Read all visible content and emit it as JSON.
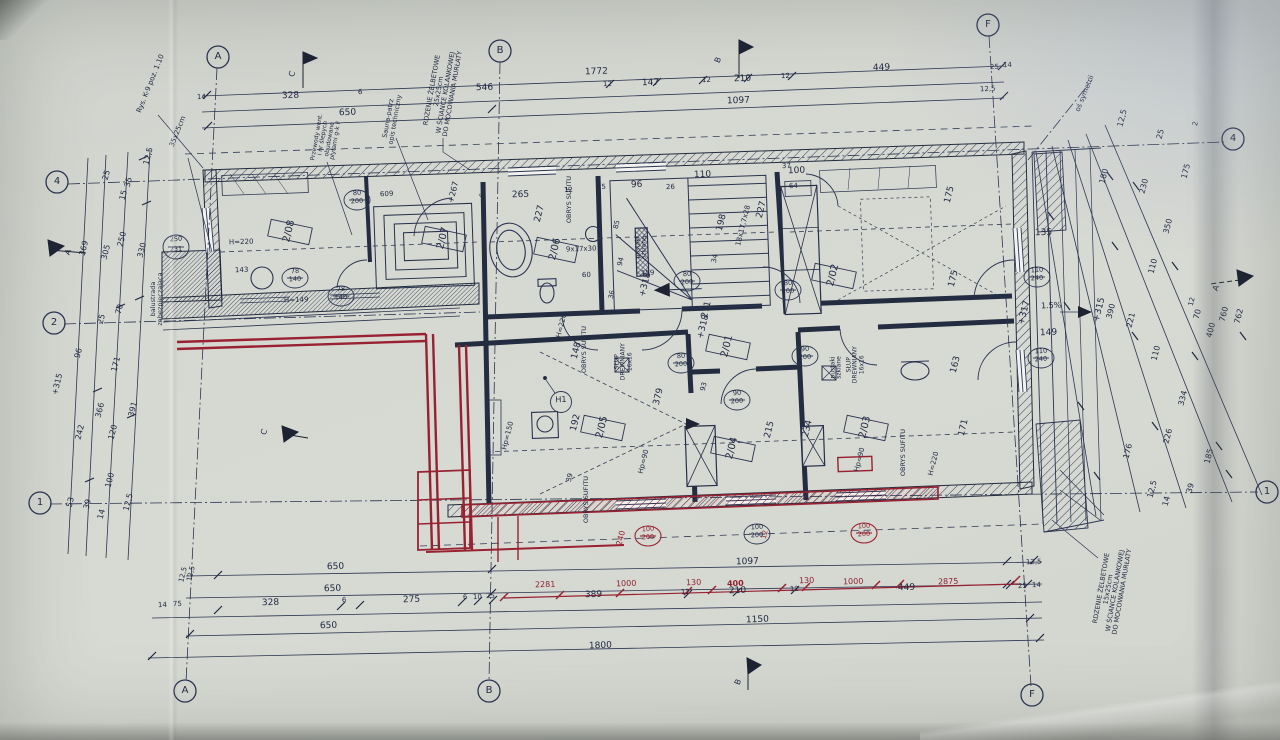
{
  "axes": {
    "A": "A",
    "B": "B",
    "C": "C",
    "F": "F",
    "n1": "1",
    "n2": "2",
    "n4": "4"
  },
  "rooms": {
    "r01": "2/01",
    "r02": "2/02",
    "r03": "2/03",
    "r04": "2/04",
    "r05": "2/05",
    "r06": "2/06",
    "r07": "2/07",
    "r08": "2/08",
    "h1": "H1"
  },
  "doors": {
    "d80": {
      "w": "80",
      "h": "200"
    },
    "d78": {
      "w": "78",
      "h": "140"
    },
    "d90": {
      "w": "90",
      "h": "200"
    },
    "d110": {
      "w": "110",
      "h": "240"
    },
    "d100": {
      "w": "100",
      "h": "200"
    },
    "d250": {
      "w": "250",
      "h": "231"
    },
    "ref609": "609"
  },
  "levels": {
    "p267": "+267",
    "p315": "+315",
    "p317": "+317",
    "p318": "+318",
    "slope": "1.5%"
  },
  "notes": {
    "rys": "Rys. K-9 poz. 1.10",
    "s3525": "35x25cm",
    "rdz25": "RDZENIE ŻELBETOWE\n25x25cm\nW ŚCIANCE KOLANKOWEJ\nDO MOCOWANIA MURŁATY",
    "rdz15": "RDZENIE ŻELBETOWE\n15x25cm\nW ŚCIANCE KOLANKOWEJ\nDO MOCOWANIA MURŁATY",
    "sauna": "Sauna-patrz\nopis techniczny",
    "przewody": "Przewody went.\ni nr ślepych\nobudowane\npłytami g-k F",
    "balustrada": "balustrada\nzabezpieczająca",
    "os": "oś symetrii",
    "obrys": "OBRYS SUFITU",
    "slup": "SŁUP\nDREWNIANY\n16x16",
    "pustaki": "pustaki\nszklane"
  },
  "dims": {
    "t1": [
      "1772",
      "449",
      "25",
      "14"
    ],
    "t2": [
      "328",
      "6",
      "546",
      "12",
      "147",
      "12",
      "210",
      "12",
      "12,5"
    ],
    "t3": [
      "650",
      "1097"
    ],
    "b1": [
      "12,5",
      "650",
      "1097",
      "12,5"
    ],
    "b2": [
      "650"
    ],
    "b3": [
      "14",
      "75",
      "328",
      "6",
      "275",
      "6",
      "10",
      "25",
      "389",
      "12",
      "210",
      "12",
      "449",
      "25",
      "14"
    ],
    "b4": [
      "650",
      "1150"
    ],
    "b5": [
      "1800"
    ],
    "red": [
      "2281",
      "1000",
      "130",
      "400",
      "130",
      "1000",
      "2875",
      "240",
      "12"
    ],
    "left": [
      "12,5",
      "35",
      "25",
      "15",
      "330",
      "250",
      "305",
      "369",
      "70",
      "25",
      "96",
      "171",
      "391",
      "366",
      "120",
      "242",
      "100",
      "12,5",
      "39",
      "53",
      "14",
      "+315"
    ],
    "right": [
      "12,5",
      "25",
      "2",
      "175",
      "180",
      "230",
      "350",
      "110",
      "12",
      "70",
      "400",
      "760",
      "762",
      "390",
      "221",
      "110",
      "334",
      "226",
      "185",
      "176",
      "12,5",
      "14",
      "39"
    ],
    "plan": [
      "265",
      "12",
      "25",
      "96",
      "26",
      "110",
      "100",
      "37",
      "64",
      "227",
      "85",
      "9x17x30",
      "94",
      "60",
      "36",
      "159",
      "227",
      "198",
      "18x17,7x28",
      "34",
      "271",
      "93",
      "379",
      "192",
      "148",
      "39",
      "215",
      "234",
      "163",
      "171",
      "175",
      "175",
      "135",
      "149",
      "143",
      "Hp=150",
      "Hp=90",
      "Hp=90",
      "H=220",
      "H=220",
      "H=220",
      "H=149",
      "6",
      "14",
      "12,5"
    ]
  }
}
